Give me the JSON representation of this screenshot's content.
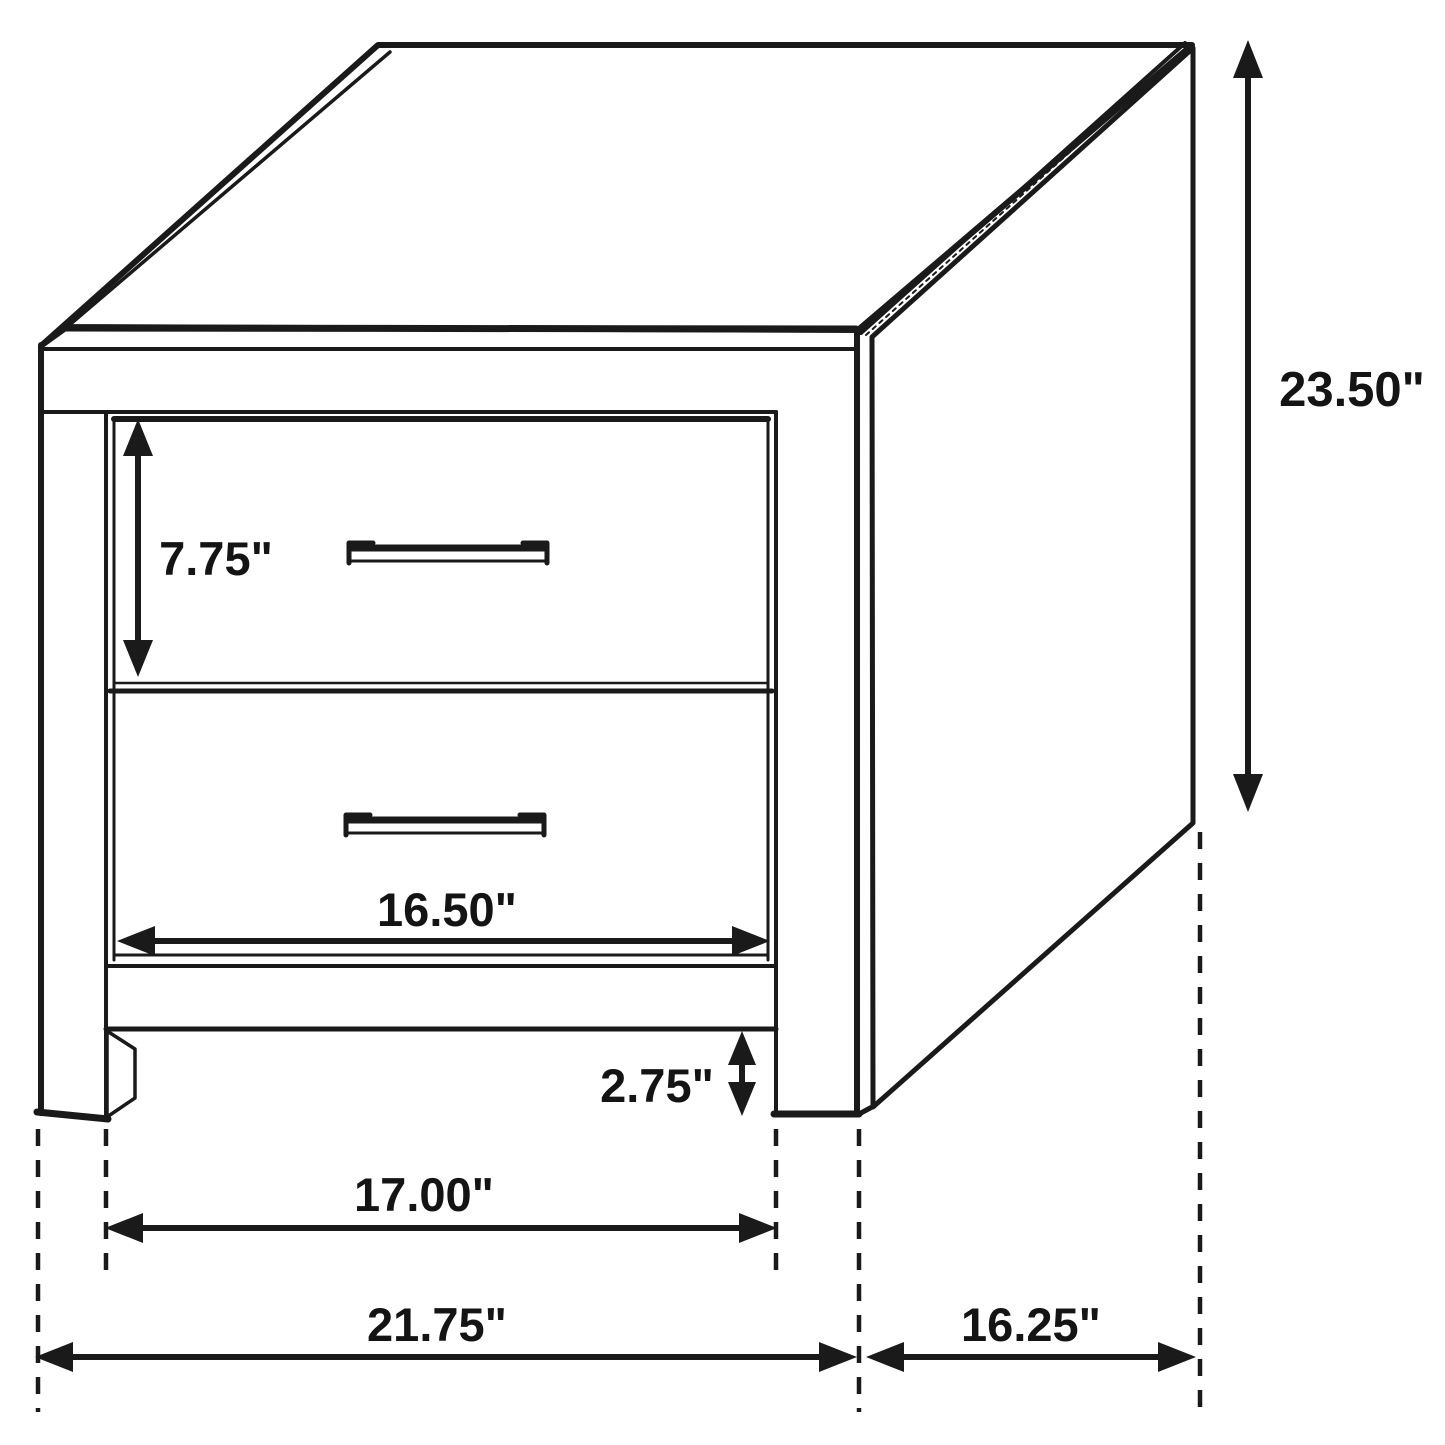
{
  "diagram": {
    "title": "Two-drawer nightstand dimension diagram",
    "style": "black line drawing, isometric view",
    "units": "inches",
    "colors": {
      "line": "#1a1a1a",
      "background": "#ffffff",
      "text": "#141414"
    },
    "object": {
      "type": "nightstand",
      "drawer_count": 2,
      "parts": [
        "top-panel",
        "face-frame",
        "upper-drawer",
        "lower-drawer",
        "drawer-handles",
        "front-legs",
        "side-panel"
      ]
    },
    "dimensions": {
      "drawer_height": "7.75\"",
      "overall_height": "23.50\"",
      "drawer_width": "16.50\"",
      "leg_height": "2.75\"",
      "inner_width": "17.00\"",
      "overall_width": "21.75\"",
      "depth": "16.25\""
    }
  }
}
